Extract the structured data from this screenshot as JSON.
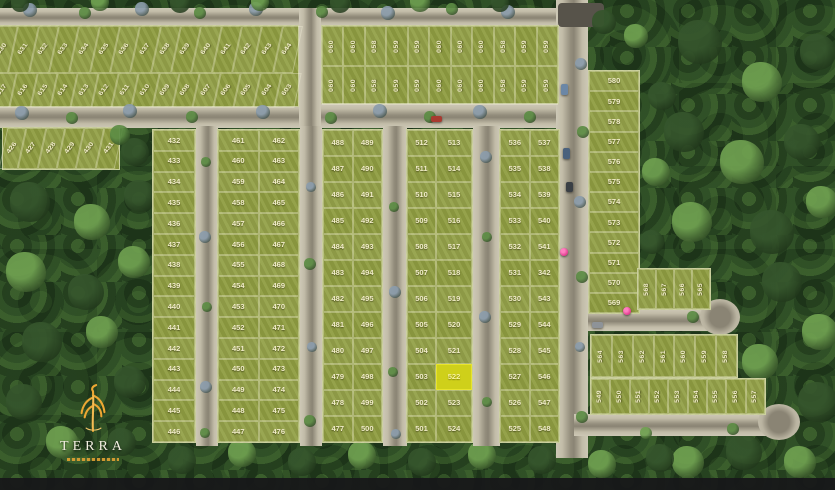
{
  "map_title": "residential master plan",
  "logo": {
    "name": "TERRA"
  },
  "highlight": {
    "lot_number": "522",
    "fill": "#cfd01a"
  },
  "colors": {
    "lot_green": "#8f9d41",
    "road": "#c9c3b1",
    "forest": "#284423",
    "highlight_yellow": "#cfd01a",
    "pin_magenta": "#e23a8e",
    "logo_orange": "#eda733",
    "label_cream": "#f1ecc9"
  },
  "blocks": {
    "top_left": {
      "row_top": [
        "630",
        "631",
        "632",
        "633",
        "634",
        "635",
        "636",
        "637",
        "638",
        "639",
        "640",
        "641",
        "642",
        "643",
        "644"
      ],
      "row_bottom": [
        "617",
        "616",
        "615",
        "614",
        "613",
        "612",
        "611",
        "610",
        "609",
        "608",
        "607",
        "606",
        "605",
        "604",
        "603"
      ]
    },
    "top_mid": {
      "pattern": [
        "060",
        "060",
        "058",
        "059",
        "059",
        "060",
        "060",
        "060",
        "058",
        "059",
        "059"
      ]
    },
    "strip_426": [
      "426",
      "427",
      "428",
      "429",
      "430",
      "431"
    ],
    "col_432": [
      "432",
      "433",
      "434",
      "435",
      "436",
      "437",
      "438",
      "439",
      "440",
      "441",
      "442",
      "443",
      "444",
      "445",
      "446"
    ],
    "pair_461": {
      "left": [
        "461",
        "460",
        "459",
        "458",
        "457",
        "456",
        "455",
        "454",
        "453",
        "452",
        "451",
        "450",
        "449",
        "448",
        "447"
      ],
      "right": [
        "462",
        "463",
        "464",
        "465",
        "466",
        "467",
        "468",
        "469",
        "470",
        "471",
        "472",
        "473",
        "474",
        "475",
        "476"
      ]
    },
    "pair_488": {
      "left": [
        "488",
        "487",
        "486",
        "485",
        "484",
        "483",
        "482",
        "481",
        "480",
        "479",
        "478",
        "477"
      ],
      "right": [
        "489",
        "490",
        "491",
        "492",
        "493",
        "494",
        "495",
        "496",
        "497",
        "498",
        "499",
        "500"
      ]
    },
    "pair_512": {
      "left": [
        "512",
        "511",
        "510",
        "509",
        "508",
        "507",
        "506",
        "505",
        "504",
        "503",
        "502",
        "501"
      ],
      "right": [
        "513",
        "514",
        "515",
        "516",
        "517",
        "518",
        "519",
        "520",
        "521",
        "522",
        "523",
        "524"
      ]
    },
    "pair_536": {
      "left": [
        "536",
        "535",
        "534",
        "533",
        "532",
        "531",
        "530",
        "529",
        "528",
        "527",
        "526",
        "525"
      ],
      "right": [
        "537",
        "538",
        "539",
        "540",
        "541",
        "342",
        "543",
        "544",
        "545",
        "546",
        "547",
        "548"
      ]
    },
    "col_569": [
      "580",
      "579",
      "578",
      "577",
      "576",
      "575",
      "574",
      "573",
      "572",
      "571",
      "570",
      "569"
    ],
    "row_565": [
      "568",
      "567",
      "566",
      "565"
    ],
    "row_558": [
      "564",
      "563",
      "562",
      "561",
      "560",
      "559",
      "558"
    ],
    "row_549": [
      "549",
      "550",
      "551",
      "552",
      "553",
      "554",
      "555",
      "556",
      "557"
    ]
  },
  "decor": {
    "tree_palette": [
      "#8b9cab",
      "#5c8c44",
      "#35552c",
      "#6fa050"
    ],
    "trees": [
      [
        30,
        10,
        7,
        0
      ],
      [
        85,
        13,
        6,
        1
      ],
      [
        142,
        9,
        7,
        0
      ],
      [
        200,
        13,
        6,
        1
      ],
      [
        256,
        9,
        7,
        0
      ],
      [
        322,
        12,
        6,
        1
      ],
      [
        388,
        13,
        7,
        0
      ],
      [
        452,
        9,
        6,
        1
      ],
      [
        508,
        12,
        7,
        0
      ],
      [
        20,
        3,
        9,
        2
      ],
      [
        100,
        2,
        9,
        3
      ],
      [
        180,
        3,
        10,
        2
      ],
      [
        260,
        2,
        9,
        3
      ],
      [
        340,
        3,
        10,
        2
      ],
      [
        420,
        2,
        10,
        3
      ],
      [
        500,
        3,
        9,
        2
      ],
      [
        22,
        113,
        7,
        0
      ],
      [
        72,
        118,
        6,
        1
      ],
      [
        130,
        111,
        7,
        0
      ],
      [
        192,
        117,
        6,
        1
      ],
      [
        263,
        112,
        7,
        0
      ],
      [
        331,
        118,
        6,
        1
      ],
      [
        380,
        111,
        7,
        0
      ],
      [
        430,
        117,
        6,
        1
      ],
      [
        480,
        112,
        7,
        0
      ],
      [
        530,
        117,
        6,
        1
      ],
      [
        206,
        162,
        5,
        1
      ],
      [
        205,
        237,
        6,
        0
      ],
      [
        207,
        307,
        5,
        1
      ],
      [
        206,
        387,
        6,
        0
      ],
      [
        205,
        433,
        5,
        1
      ],
      [
        311,
        187,
        5,
        0
      ],
      [
        310,
        264,
        6,
        1
      ],
      [
        312,
        347,
        5,
        0
      ],
      [
        310,
        421,
        6,
        1
      ],
      [
        394,
        207,
        5,
        1
      ],
      [
        395,
        292,
        6,
        0
      ],
      [
        393,
        372,
        5,
        1
      ],
      [
        396,
        434,
        5,
        0
      ],
      [
        486,
        157,
        6,
        0
      ],
      [
        487,
        237,
        5,
        1
      ],
      [
        485,
        317,
        6,
        0
      ],
      [
        487,
        402,
        5,
        1
      ],
      [
        581,
        64,
        6,
        0
      ],
      [
        583,
        132,
        6,
        1
      ],
      [
        580,
        202,
        6,
        0
      ],
      [
        582,
        277,
        6,
        1
      ],
      [
        580,
        347,
        5,
        0
      ],
      [
        582,
        417,
        6,
        1
      ],
      [
        693,
        317,
        6,
        1
      ],
      [
        646,
        433,
        6,
        3
      ],
      [
        733,
        429,
        6,
        1
      ],
      [
        120,
        135,
        10,
        1
      ],
      [
        135,
        152,
        14,
        2
      ],
      [
        700,
        42,
        22,
        2
      ],
      [
        762,
        82,
        20,
        3
      ],
      [
        818,
        52,
        18,
        2
      ],
      [
        684,
        132,
        20,
        2
      ],
      [
        742,
        162,
        22,
        3
      ],
      [
        802,
        142,
        18,
        2
      ],
      [
        692,
        222,
        20,
        3
      ],
      [
        772,
        232,
        22,
        2
      ],
      [
        822,
        202,
        16,
        3
      ],
      [
        782,
        282,
        20,
        2
      ],
      [
        820,
        332,
        18,
        3
      ],
      [
        700,
        382,
        20,
        2
      ],
      [
        760,
        362,
        18,
        3
      ],
      [
        818,
        402,
        20,
        2
      ],
      [
        688,
        462,
        16,
        3
      ],
      [
        744,
        452,
        18,
        2
      ],
      [
        800,
        462,
        16,
        3
      ],
      [
        604,
        22,
        12,
        2
      ],
      [
        636,
        36,
        12,
        3
      ],
      [
        662,
        96,
        14,
        2
      ],
      [
        656,
        172,
        14,
        3
      ],
      [
        652,
        242,
        12,
        2
      ],
      [
        30,
        202,
        20,
        2
      ],
      [
        92,
        222,
        18,
        3
      ],
      [
        140,
        196,
        16,
        2
      ],
      [
        26,
        272,
        20,
        3
      ],
      [
        86,
        292,
        18,
        2
      ],
      [
        134,
        262,
        16,
        3
      ],
      [
        42,
        342,
        20,
        2
      ],
      [
        102,
        332,
        16,
        3
      ],
      [
        24,
        402,
        18,
        2
      ],
      [
        130,
        382,
        16,
        2
      ],
      [
        62,
        442,
        16,
        3
      ],
      [
        122,
        442,
        14,
        2
      ],
      [
        182,
        460,
        14,
        2
      ],
      [
        242,
        453,
        14,
        3
      ],
      [
        302,
        462,
        14,
        2
      ],
      [
        362,
        455,
        14,
        3
      ],
      [
        422,
        462,
        14,
        2
      ],
      [
        482,
        455,
        14,
        3
      ],
      [
        542,
        460,
        14,
        2
      ],
      [
        602,
        464,
        14,
        3
      ],
      [
        660,
        458,
        14,
        2
      ]
    ],
    "cars": [
      [
        431,
        116,
        11,
        6,
        "#a83a30"
      ],
      [
        561,
        84,
        7,
        11,
        "#6b87a6"
      ],
      [
        563,
        148,
        7,
        11,
        "#4a617d"
      ],
      [
        566,
        182,
        7,
        10,
        "#3a3f45"
      ],
      [
        592,
        322,
        11,
        6,
        "#8e9398"
      ]
    ],
    "pins": [
      [
        564,
        252
      ],
      [
        627,
        311
      ]
    ]
  }
}
